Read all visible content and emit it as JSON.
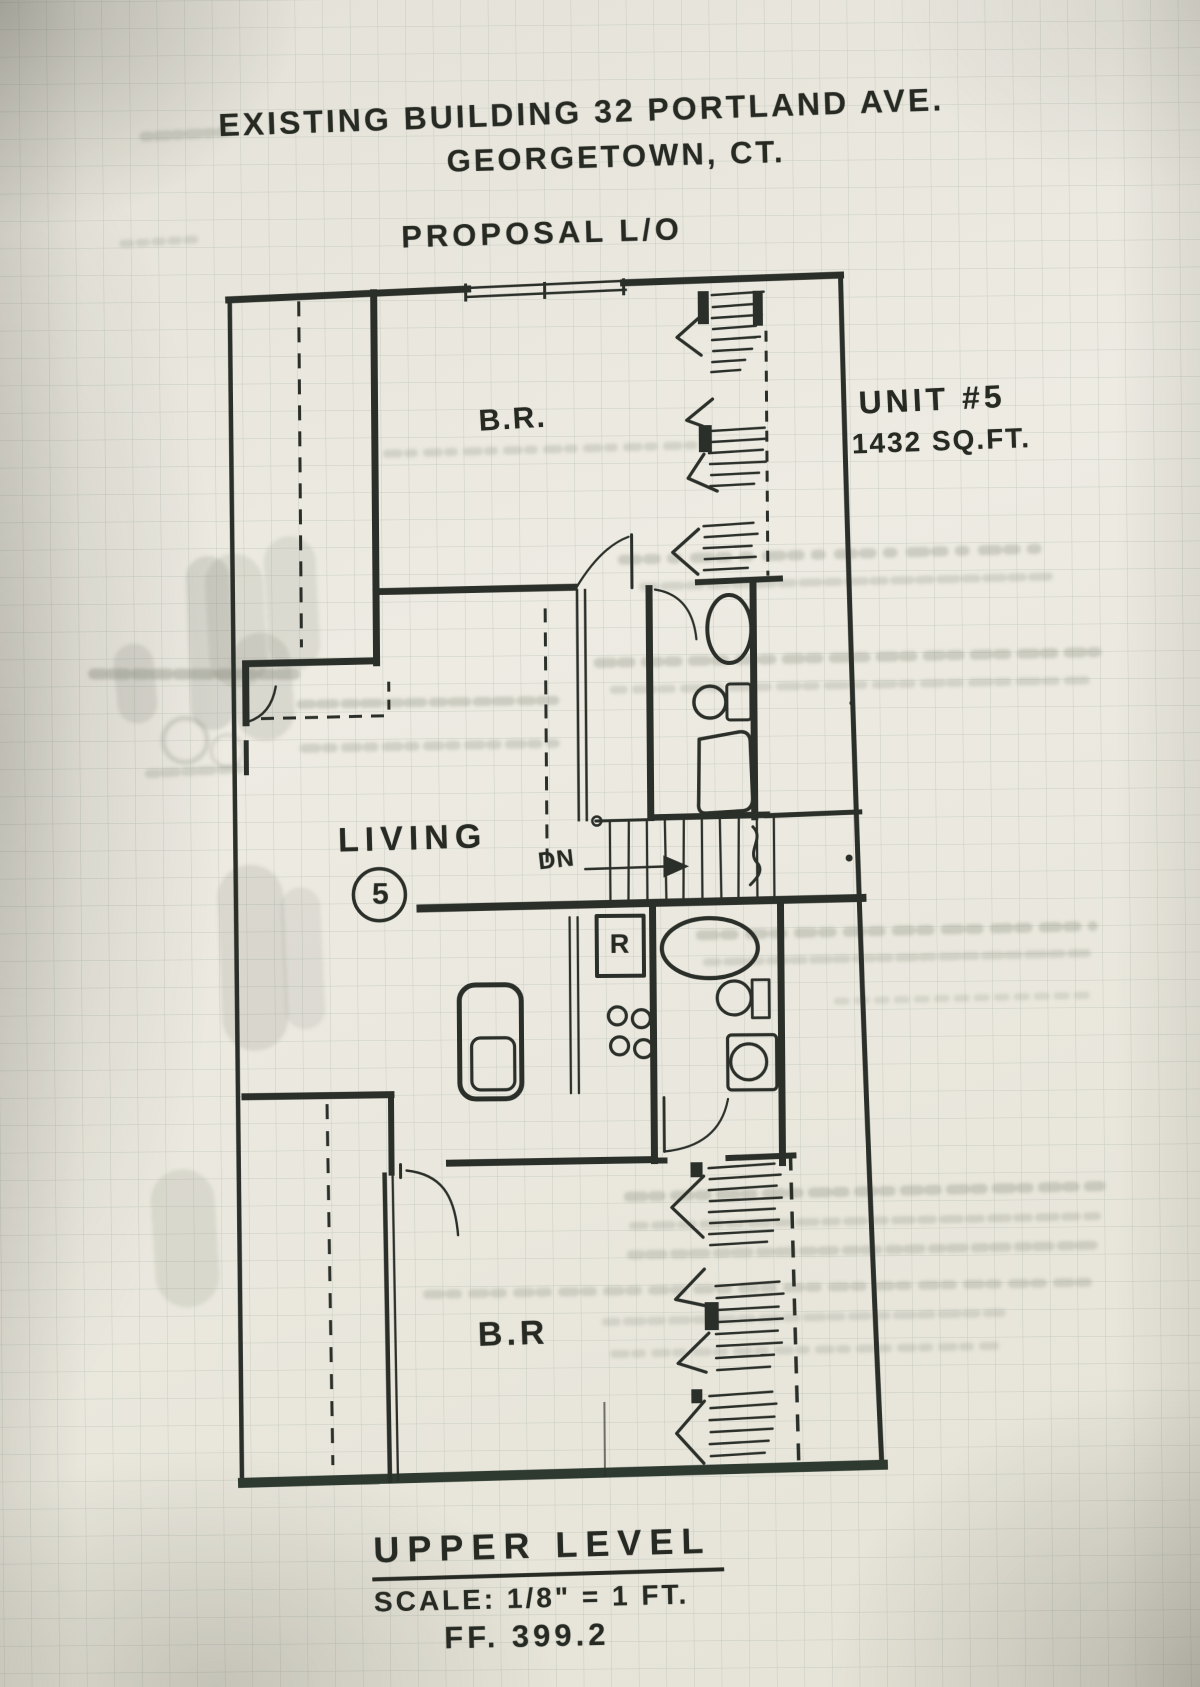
{
  "document": {
    "title_line1": "EXISTING BUILDING 32 PORTLAND AVE.",
    "title_line2": "GEORGETOWN, CT.",
    "subtitle": "PROPOSAL L/O"
  },
  "unit": {
    "name": "UNIT #5",
    "area": "1432 SQ.FT."
  },
  "rooms": {
    "bedroom_upper": "B.R.",
    "living": "LIVING",
    "living_unit_number": "5",
    "bedroom_lower": "B.R"
  },
  "annotations": {
    "stairs_down": "DN",
    "refrigerator": "R"
  },
  "footer": {
    "level": "UPPER LEVEL",
    "scale": "SCALE: 1/8\" = 1 FT.",
    "finish_floor": "FF. 399.2"
  },
  "colors": {
    "ink": "#2b2f29",
    "paper": "#e9e7de",
    "grid": "#adb8ad",
    "ghost": "#6f7568"
  }
}
